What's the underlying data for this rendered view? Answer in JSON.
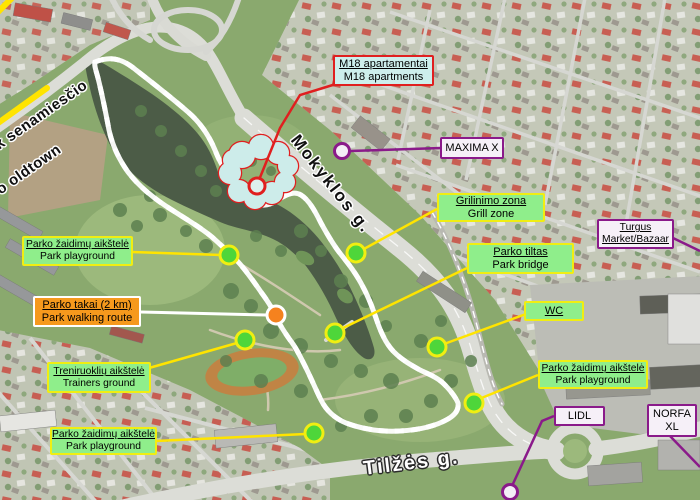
{
  "title": "Annotated satellite map of city park",
  "street_labels": {
    "mokyklos": "Mokyklos g.",
    "tilzes": "Tilžės g.",
    "oldtown_lt": "Link senamiesčio",
    "oldtown_en": "To oldtown"
  },
  "callouts": {
    "m18": {
      "line1": "M18 apartamentai",
      "line2": "M18 apartments"
    },
    "maxima": {
      "line1": "MAXIMA X"
    },
    "grill": {
      "line1": "Grilinimo zona",
      "line2": "Grill zone"
    },
    "turgus": {
      "line1": "Turgus",
      "line2": "Market/Bazaar"
    },
    "bridge": {
      "line1": "Parko tiltas",
      "line2": "Park bridge"
    },
    "wc": {
      "line1": "WC"
    },
    "playground_nw": {
      "line1": "Parko žaidimų aikštelė",
      "line2": "Park playground"
    },
    "walking": {
      "line1": "Parko takai (2 km)",
      "line2": "Park walking route"
    },
    "trainers": {
      "line1": "Treniruoklių aikštelė",
      "line2": "Trainers ground"
    },
    "playground_sw": {
      "line1": "Parko žaidimų aikštelė",
      "line2": "Park playground"
    },
    "playground_e": {
      "line1": "Parko žaidimų aikštelė",
      "line2": "Park playground"
    },
    "lidl": {
      "line1": "LIDL"
    },
    "norfa": {
      "line1": "NORFA",
      "line2": "XL"
    }
  },
  "colors": {
    "callout_green_bg": "#8fee8b",
    "callout_yellow_border": "#f0ee12",
    "callout_orange_bg": "#f6991d",
    "callout_cyan_bg": "#cdeeec",
    "purple": "#8a1a8a",
    "red": "#e01f1f",
    "line_yellow": "#ffe400",
    "line_white": "#ffffff",
    "route_orange": "#f08a00",
    "oldtown_route_yellow": "#ffe400",
    "marker_green": "#4ed63a",
    "marker_orange": "#f5821e",
    "marker_purple_fill": "#f4eef6",
    "water": "#4c5c47"
  }
}
